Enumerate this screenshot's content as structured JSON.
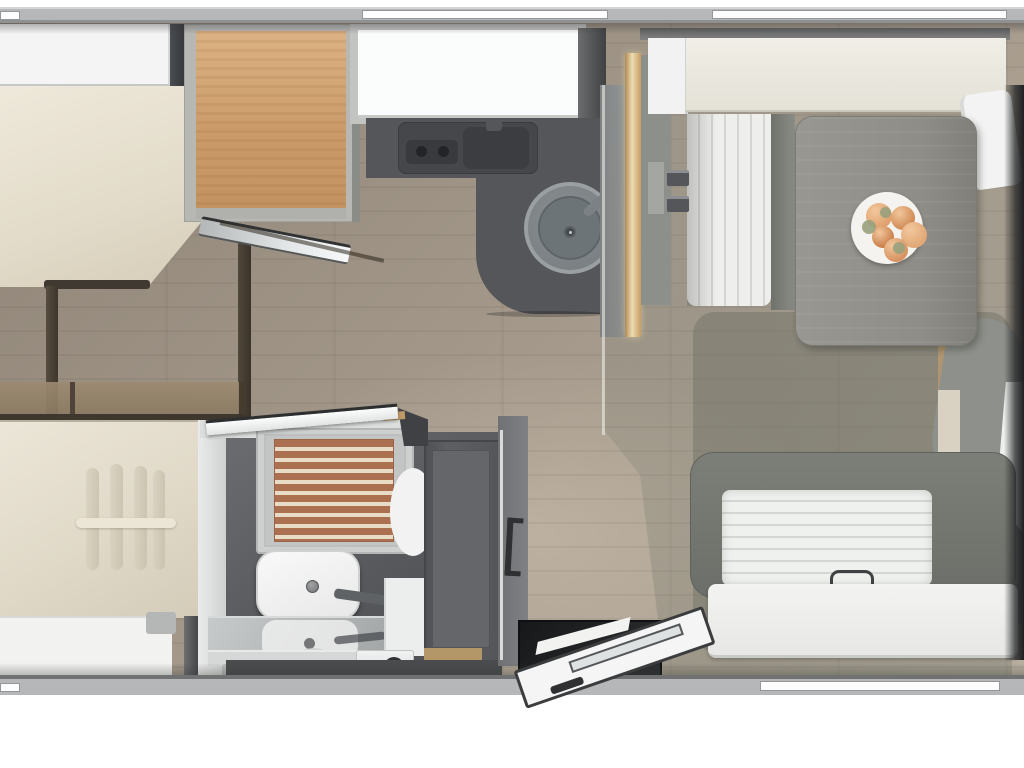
{
  "title": "caravan-floorplan-top-view",
  "colors": {
    "outside": "#ffffff",
    "wall": "#b5b7b9",
    "wall_light": "#d2d4d6",
    "wall_dark": "#6f7173",
    "floor_wood": "#a2968a",
    "counter": "#55565a",
    "cabinet_wood": "#cb9c6a",
    "mattress_cream": "#e8e2d2",
    "panel_white": "#f4f5f4",
    "table_gray": "#8e8d87",
    "bench_gray": "#73766f",
    "bath_floor": "#55575b",
    "wardrobe_gray": "#595b5f",
    "shower_wood": "#aa7050",
    "shower_slat": "#e9dcc6",
    "door_frame_dark": "#3a3c3e",
    "food_orange": "#d5925f"
  },
  "fixtures": {
    "front_bed": "front bed with headboard",
    "overhead_locker": "open overhead locker with wood interior",
    "kitchen": "kitchen block with hob and sink",
    "sink": "round sink with faucet",
    "dinette": "dinette with table and benches",
    "plate": "plate with croissants",
    "rear_bench": "rear bench seat",
    "entry_door": "open entry door with steps",
    "bathroom": "bathroom with shower, toilet, basin and wardrobe",
    "rear_bed": "rear bed with pleated duvet"
  },
  "food_items": [
    {
      "x": 866,
      "y": 203,
      "d": 26,
      "c": "#e0a06d"
    },
    {
      "x": 891,
      "y": 206,
      "d": 24,
      "c": "#d08a54"
    },
    {
      "x": 901,
      "y": 222,
      "d": 26,
      "c": "#e2a876"
    },
    {
      "x": 872,
      "y": 226,
      "d": 22,
      "c": "#c97e49"
    },
    {
      "x": 884,
      "y": 238,
      "d": 24,
      "c": "#d69260"
    }
  ],
  "leaves": [
    {
      "x": 862,
      "y": 220,
      "d": 14
    },
    {
      "x": 893,
      "y": 242,
      "d": 12
    },
    {
      "x": 880,
      "y": 207,
      "d": 11
    }
  ],
  "pleats": [
    {
      "x": 86,
      "y": 468,
      "w": 13,
      "h": 102
    },
    {
      "x": 110,
      "y": 464,
      "w": 13,
      "h": 106
    },
    {
      "x": 134,
      "y": 466,
      "w": 13,
      "h": 104
    },
    {
      "x": 153,
      "y": 470,
      "w": 12,
      "h": 100
    }
  ]
}
